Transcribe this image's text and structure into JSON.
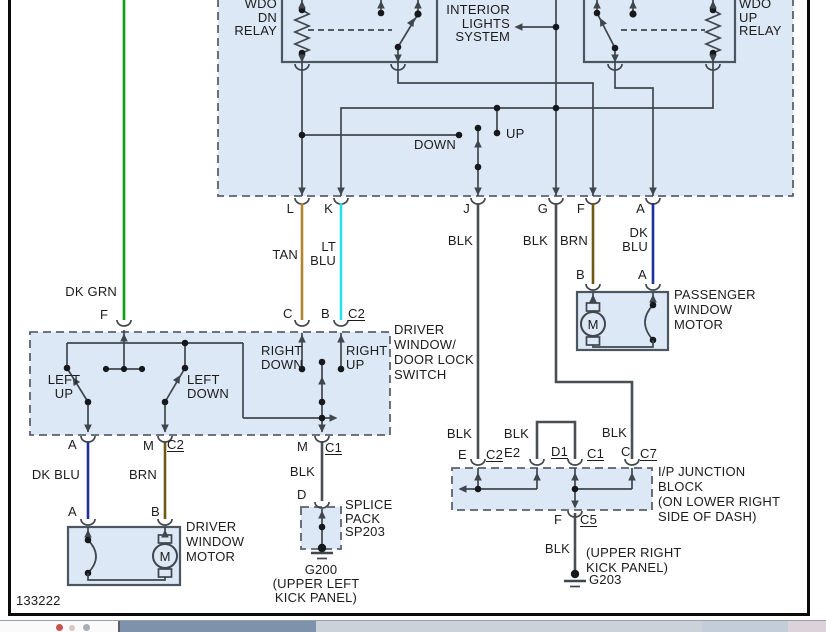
{
  "colors": {
    "tan": "#b3862e",
    "lt_blu": "#25dff2",
    "brn": "#6e5812",
    "dk_blu": "#20309c",
    "dk_grn": "#0f9e0f",
    "blk_wire": "#4a4f54",
    "line": "#3f464e",
    "text": "#1c1c1c",
    "section_fill": "#dce8f5",
    "frame": "#0a0a0a"
  },
  "figure_number": "133222",
  "relay_section": {
    "wdo_dn_relay": "WDO\nDN\nRELAY",
    "wdo_up_relay": "WDO\nUP\nRELAY",
    "interior_lights_system": "INTERIOR\nLIGHTS\nSYSTEM",
    "down_label": "DOWN",
    "up_label": "UP",
    "pins": {
      "l": "L",
      "k": "K",
      "j": "J",
      "g": "G",
      "f": "F",
      "a": "A"
    }
  },
  "wires": {
    "tan": "TAN",
    "lt_blu": "LT\nBLU",
    "blk_j": "BLK",
    "blk_g": "BLK",
    "brn": "BRN",
    "dk_blu": "DK\nBLU",
    "dk_grn": "DK GRN",
    "dk_blu_motor": "DK BLU",
    "brn_motor": "BRN",
    "blk_switch": "BLK",
    "blk_e": "BLK",
    "blk_e2": "BLK",
    "blk_c": "BLK",
    "blk_f": "BLK"
  },
  "driver_switch": {
    "title": "DRIVER\nWINDOW/\nDOOR LOCK\nSWITCH",
    "left_up": "LEFT\nUP",
    "left_down": "LEFT\nDOWN",
    "right_down": "RIGHT\nDOWN",
    "right_up": "RIGHT\nUP",
    "pin_f": "F",
    "pin_c": "C",
    "pin_b": "B",
    "conn_c2_top": "C2",
    "pin_a": "A",
    "pin_m1": "M",
    "conn_c2_bottom": "C2",
    "pin_m2": "M",
    "conn_c1": "C1"
  },
  "passenger_motor": {
    "title": "PASSENGER\nWINDOW\nMOTOR",
    "pin_b": "B",
    "pin_a": "A",
    "motor_letter": "M"
  },
  "driver_motor": {
    "title": "DRIVER\nWINDOW\nMOTOR",
    "pin_a": "A",
    "pin_b": "B",
    "motor_letter": "M"
  },
  "splice_pack": {
    "pin_d": "D",
    "label": "SPLICE\nPACK\nSP203",
    "ground_id": "G200",
    "location": "(UPPER LEFT\nKICK PANEL)"
  },
  "junction_block": {
    "title": "I/P JUNCTION\nBLOCK\n(ON LOWER RIGHT\nSIDE OF DASH)",
    "pin_e": "E",
    "conn_c2": "C2",
    "pin_e2": "E2",
    "conn_d1": "D1",
    "conn_c1": "C1",
    "pin_c": "C",
    "conn_c7": "C7",
    "pin_f": "F",
    "conn_c5": "C5",
    "ground_id": "G203",
    "ground_location": "(UPPER RIGHT\nKICK PANEL)"
  }
}
